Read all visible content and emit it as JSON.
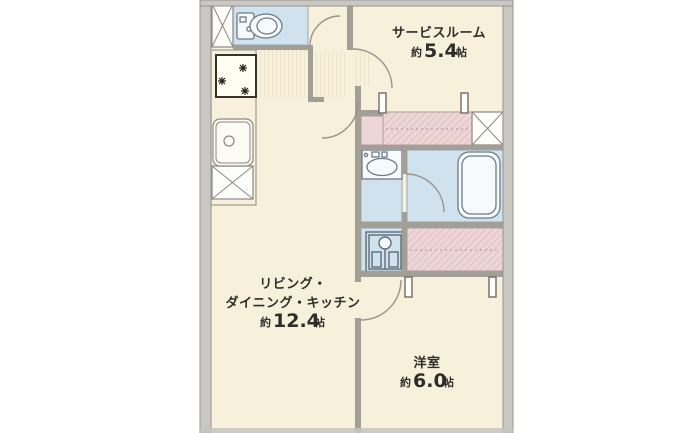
{
  "page": {
    "type": "apartment-floor-plan",
    "background": "#ffffff"
  },
  "rooms": {
    "service_room": {
      "name": "サービスルーム",
      "area_prefix": "約",
      "area_value": "5.4",
      "area_unit": "帖"
    },
    "ldk": {
      "name_line1": "リビング・",
      "name_line2": "ダイニング・キッチン",
      "area_prefix": "約",
      "area_value": "12.4",
      "area_unit": "帖"
    },
    "western_room": {
      "name": "洋室",
      "area_prefix": "約",
      "area_value": "6.0",
      "area_unit": "帖"
    }
  },
  "icons": {
    "toilet": "toilet-icon",
    "gas_stove": "gas-stove-icon",
    "kitchen_sink": "kitchen-sink-icon",
    "washbasin": "washbasin-icon",
    "bathtub": "bathtub-icon",
    "washing_machine": "washing-machine-icon",
    "pipe_space": "x-box-icon"
  },
  "colors": {
    "floor": "#f7f1db",
    "wet_area": "#cfe2ee",
    "closet": "#eed6d6",
    "wall_exterior": "#c9c8c3",
    "wall_interior": "#a29f97",
    "text": "#2e2d29",
    "background": "#ffffff"
  }
}
